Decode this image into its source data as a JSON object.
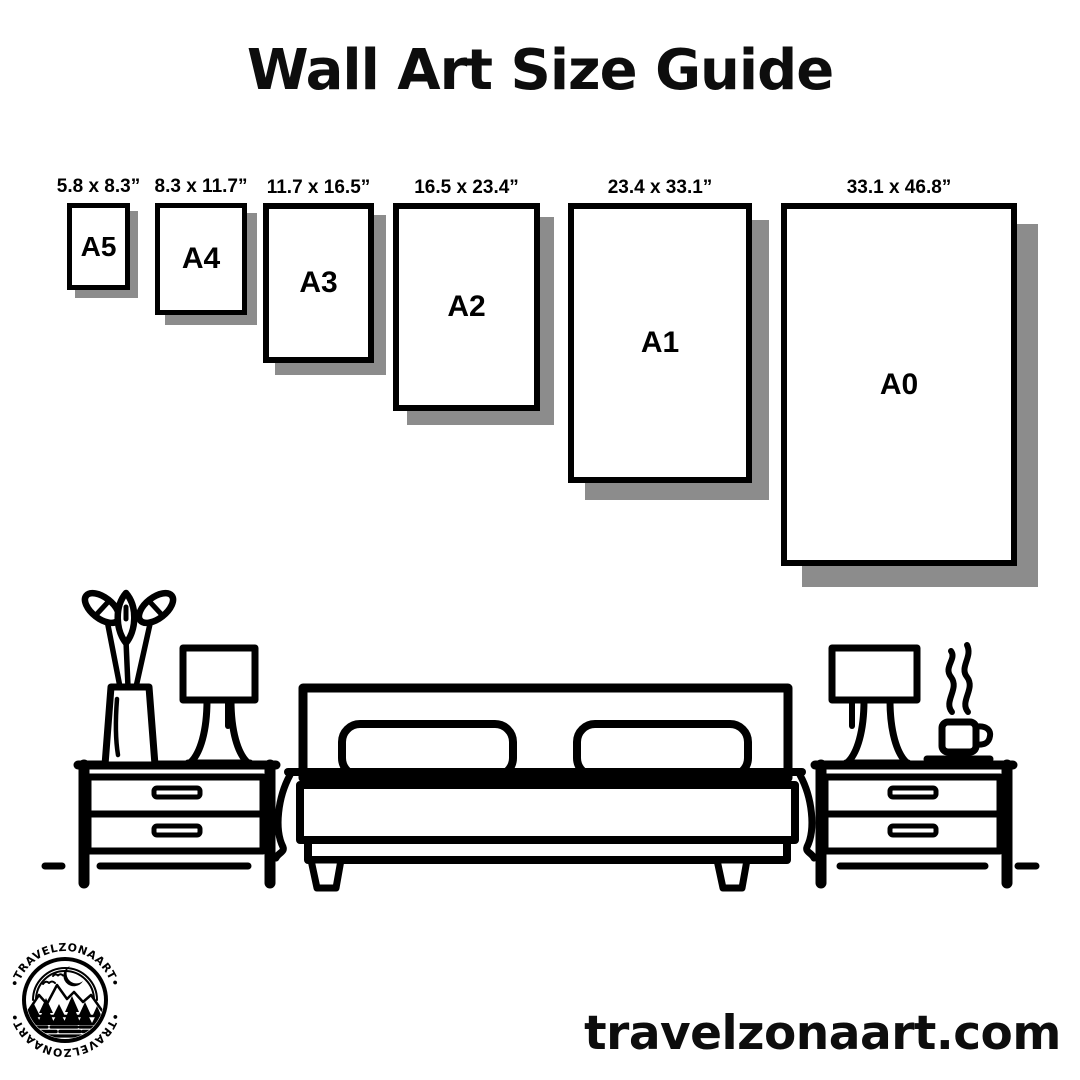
{
  "title": "Wall Art Size Guide",
  "sizes": [
    {
      "name": "A5",
      "dimensions": "5.8 x 8.3”"
    },
    {
      "name": "A4",
      "dimensions": "8.3 x 11.7”"
    },
    {
      "name": "A3",
      "dimensions": "11.7 x 16.5”"
    },
    {
      "name": "A2",
      "dimensions": "16.5 x 23.4”"
    },
    {
      "name": "A1",
      "dimensions": "23.4 x 33.1”"
    },
    {
      "name": "A0",
      "dimensions": "33.1 x 46.8”"
    }
  ],
  "logo": {
    "brand": "TRAVELZONAART",
    "text_top": "•TRAVELZONAART•",
    "text_bottom": "•TRAVELZONAART•"
  },
  "footer": {
    "website": "travelzonaart.com"
  },
  "colors": {
    "ink": "#000000",
    "shadow": "#8c8c8c",
    "background": "#ffffff"
  },
  "scene": {
    "items": [
      "plant-vase",
      "table-lamp",
      "nightstand",
      "double-bed",
      "pillow",
      "blanket",
      "coffee-cup",
      "steam",
      "floor-line"
    ]
  }
}
